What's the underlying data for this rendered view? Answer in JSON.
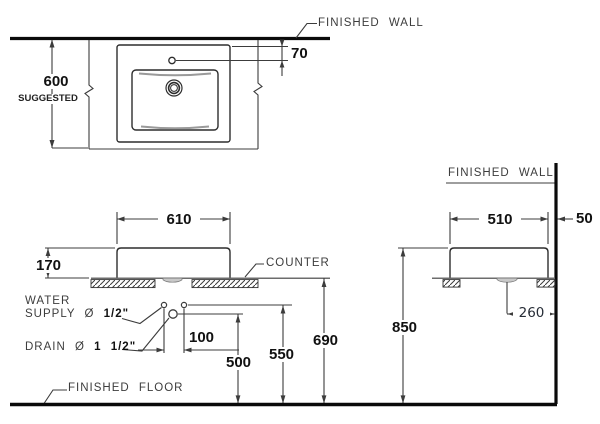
{
  "diagram": {
    "title_semantic": "lavatory-installation-dimension-drawing",
    "colors": {
      "background": "#ffffff",
      "thin_line": "#3c3c3c",
      "thick_line": "#0a0a0a",
      "shade": "#999999"
    },
    "labels": {
      "finished_wall_top": "FINISHED WALL",
      "finished_wall_right": "FINISHED WALL",
      "finished_floor": "FINISHED FLOOR",
      "counter": "COUNTER",
      "water_supply_line1": "WATER",
      "water_supply_prefix": "SUPPLY Ø ",
      "water_supply_size": "1/2\"",
      "drain_prefix": "DRAIN Ø ",
      "drain_size": "1 1/2\"",
      "suggested": "SUGGESTED"
    },
    "dimensions": {
      "counter_depth": "600",
      "faucet_offset": "70",
      "sink_width_left_view": "610",
      "sink_body_height": "170",
      "supply_spacing": "100",
      "drain_height": "500",
      "supply_height": "550",
      "counter_top_height": "690",
      "rim_height": "850",
      "sink_width_right_view": "510",
      "wall_clearance": "50",
      "drain_wall_offset": "260"
    }
  }
}
